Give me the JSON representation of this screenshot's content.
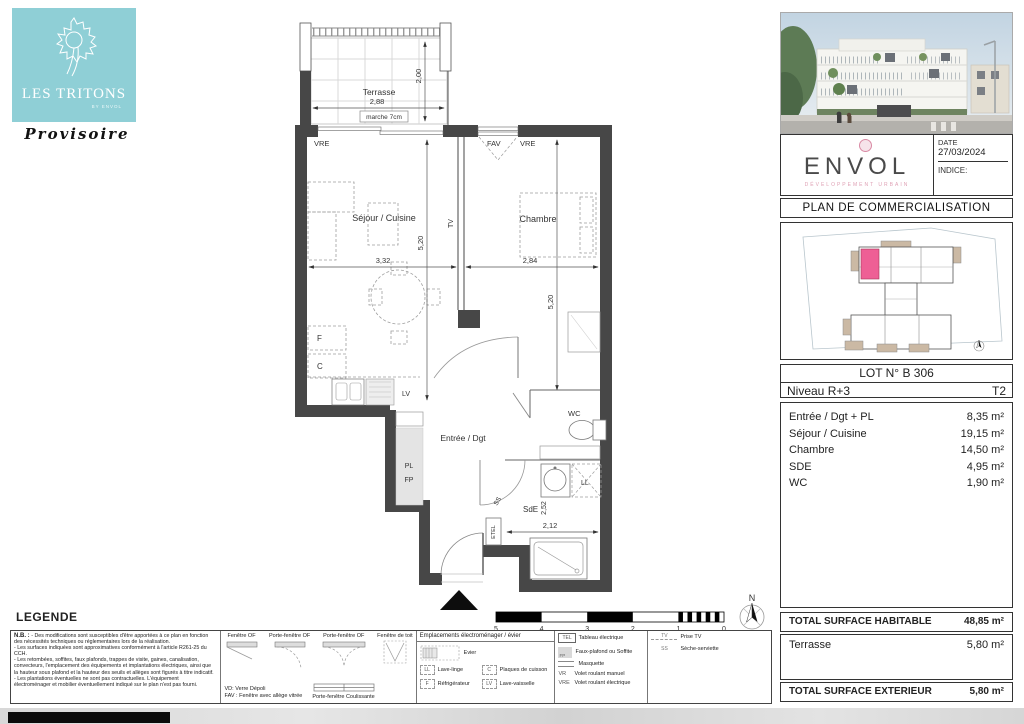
{
  "branding": {
    "title": "LES TRITONS",
    "by": "BY ENVOL",
    "status": "Provisoire",
    "teal": "#8FCFD6",
    "pink": "#EE5F95",
    "developer": "ENVOL",
    "tagline": "DÉVELOPPEMENT URBAIN"
  },
  "sidebar": {
    "date_label": "DATE",
    "date": "27/03/2024",
    "indice": "INDICE:",
    "doc_title": "PLAN DE COMMERCIALISATION",
    "lot": "LOT N° B 306",
    "level": "Niveau R+3",
    "type": "T2",
    "areas": [
      {
        "label": "Entrée / Dgt + PL",
        "value": "8,35 m²"
      },
      {
        "label": "Séjour / Cuisine",
        "value": "19,15 m²"
      },
      {
        "label": "Chambre",
        "value": "14,50 m²"
      },
      {
        "label": "SDE",
        "value": "4,95 m²"
      },
      {
        "label": "WC",
        "value": "1,90 m²"
      }
    ],
    "total_hab_label": "TOTAL SURFACE HABITABLE",
    "total_hab": "48,85 m²",
    "terrasse_label": "Terrasse",
    "terrasse": "5,80 m²",
    "total_ext_label": "TOTAL SURFACE EXTERIEUR",
    "total_ext": "5,80 m²"
  },
  "plan": {
    "north": "N",
    "labels": {
      "terrasse": "Terrasse",
      "marche": "marche 7cm",
      "vre_left": "VRE",
      "fav": "FAV",
      "vre_right": "VRE",
      "sejour": "Séjour / Cuisine",
      "tv": "TV",
      "chambre": "Chambre",
      "f": "F",
      "c": "C",
      "lv": "LV",
      "pl": "PL",
      "fp": "FP",
      "entree": "Entrée / Dgt",
      "wc": "WC",
      "ll": "LL",
      "sde": "SdE",
      "etel": "ETEL",
      "ss": "SS"
    },
    "dims": {
      "terrasse_w": "2,88",
      "terrasse_d": "2,00",
      "sejour_w": "3,32",
      "sejour_h": "5,20",
      "chambre_w": "2,84",
      "chambre_h": "5,20",
      "sde_w": "2,12",
      "sde_h": "2,52"
    },
    "scale": [
      "5",
      "4",
      "3",
      "2",
      "1",
      "0"
    ]
  },
  "legend": {
    "title": "LEGENDE",
    "nb_bold": "N.B. :",
    "nb": "- Des modifications sont susceptibles d'être apportées à ce plan en fonction des nécessités techniques ou réglementaires lors de la réalisation.\n- Les surfaces indiquées sont approximatives conformément à l'article R261-25 du CCH.\n- Les retombées, soffites, faux plafonds, trappes de visite, gaines, canalisation, convecteurs, l'emplacement des équipements et implantations électriques, ainsi que la hauteur sous plafond et la hauteur des seuils et allèges sont figurés à titre indicatif.\n- Les plantations éventuelles ne sont pas contractuelles. L'équipement électroménager et mobilier éventuellement indiqué sur le plan n'est pas fourni.",
    "windows": {
      "w1": "Fenêtre OF",
      "w2": "Porte-fenêtre OF",
      "w3": "Porte-fenêtre OF",
      "w4": "Fenêtre de toit",
      "note1": "VD: Verre Dépoli",
      "note2": "FAV : Fenêtre avec allège vitrée",
      "slider": "Porte-fenêtre Coulissante"
    },
    "appliances": {
      "header": "Emplacements électroménager / évier",
      "evier": "Evier",
      "items": [
        {
          "code": "LL",
          "label": "Lave-linge"
        },
        {
          "code": "C",
          "label": "Plaques de cuisson"
        },
        {
          "code": "F",
          "label": "Réfrigérateur"
        },
        {
          "code": "LV",
          "label": "Lave-vaisselle"
        }
      ]
    },
    "electrical": {
      "tel_code": "TEL",
      "tel": "Tableau électrique",
      "fp_code": "FP",
      "fp": "Faux-plafond ou Soffite",
      "masquette": "Masquette",
      "vr_code": "VR",
      "vr": "Volet roulant manuel",
      "vre_code": "VRE",
      "vre": "Volet roulant électrique"
    },
    "misc": {
      "tv_code": "TV",
      "tv": "Prise TV",
      "ss_code": "SS",
      "ss": "Sèche-serviette"
    }
  }
}
